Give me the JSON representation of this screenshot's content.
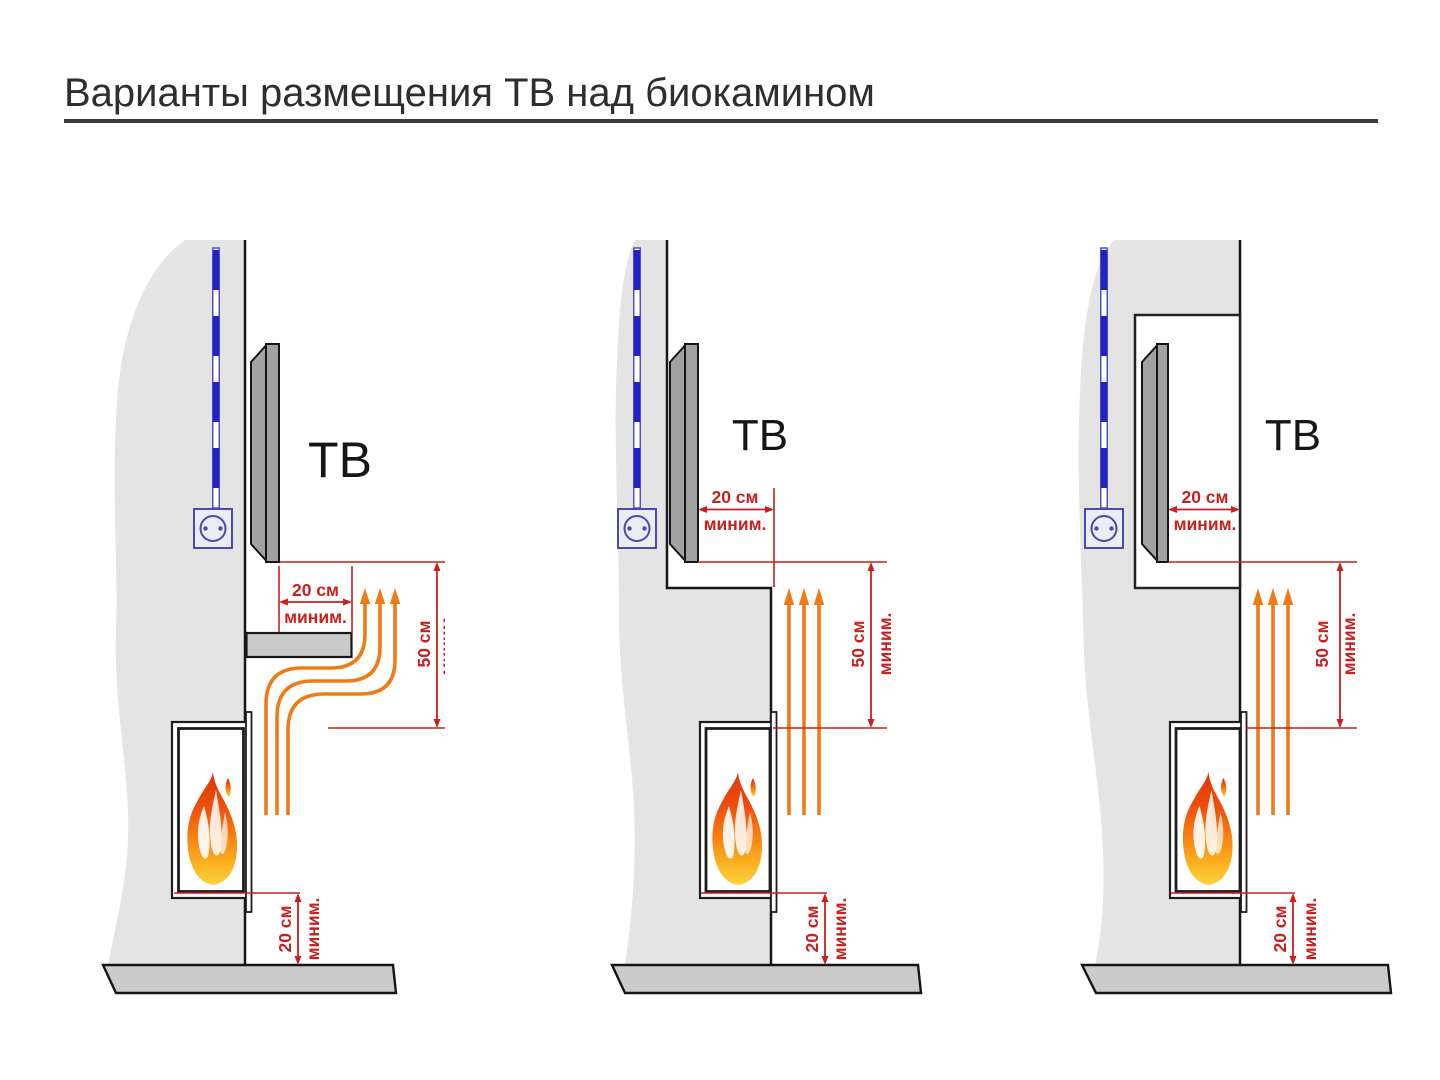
{
  "title": "Варианты размещения ТВ над биокамином",
  "colors": {
    "dimension_red": "#c9201d",
    "heat_orange": "#ee7b17",
    "cable_blue": "#2323c4",
    "outlet_blue": "#4949ae",
    "wall_gray": "#e4e4e4",
    "floor_gray": "#cbcbcb",
    "tv_gray": "#a2a2a2",
    "title_color": "#2e2e2e"
  },
  "icons": {
    "flame": "flame-icon",
    "outlet": "power-outlet-icon",
    "cable": "power-cable-icon",
    "heat_arrows": "heat-flow-arrows-icon"
  },
  "diagrams": [
    {
      "id": "variant-1",
      "tv_label": "ТВ",
      "dim_front_gap": {
        "value": "20 см",
        "qualifier": "миним."
      },
      "dim_height_clearance": {
        "value": "50 см",
        "qualifier": "миним."
      },
      "dim_floor_clearance": {
        "value": "20 см",
        "qualifier": "миним."
      }
    },
    {
      "id": "variant-2",
      "tv_label": "ТВ",
      "dim_front_gap": {
        "value": "20 см",
        "qualifier": "миним."
      },
      "dim_height_clearance": {
        "value": "50 см",
        "qualifier": "миним."
      },
      "dim_floor_clearance": {
        "value": "20 см",
        "qualifier": "миним."
      }
    },
    {
      "id": "variant-3",
      "tv_label": "ТВ",
      "dim_front_gap": {
        "value": "20 см",
        "qualifier": "миним."
      },
      "dim_height_clearance": {
        "value": "50 см",
        "qualifier": "миним."
      },
      "dim_floor_clearance": {
        "value": "20 см",
        "qualifier": "миним."
      }
    }
  ]
}
